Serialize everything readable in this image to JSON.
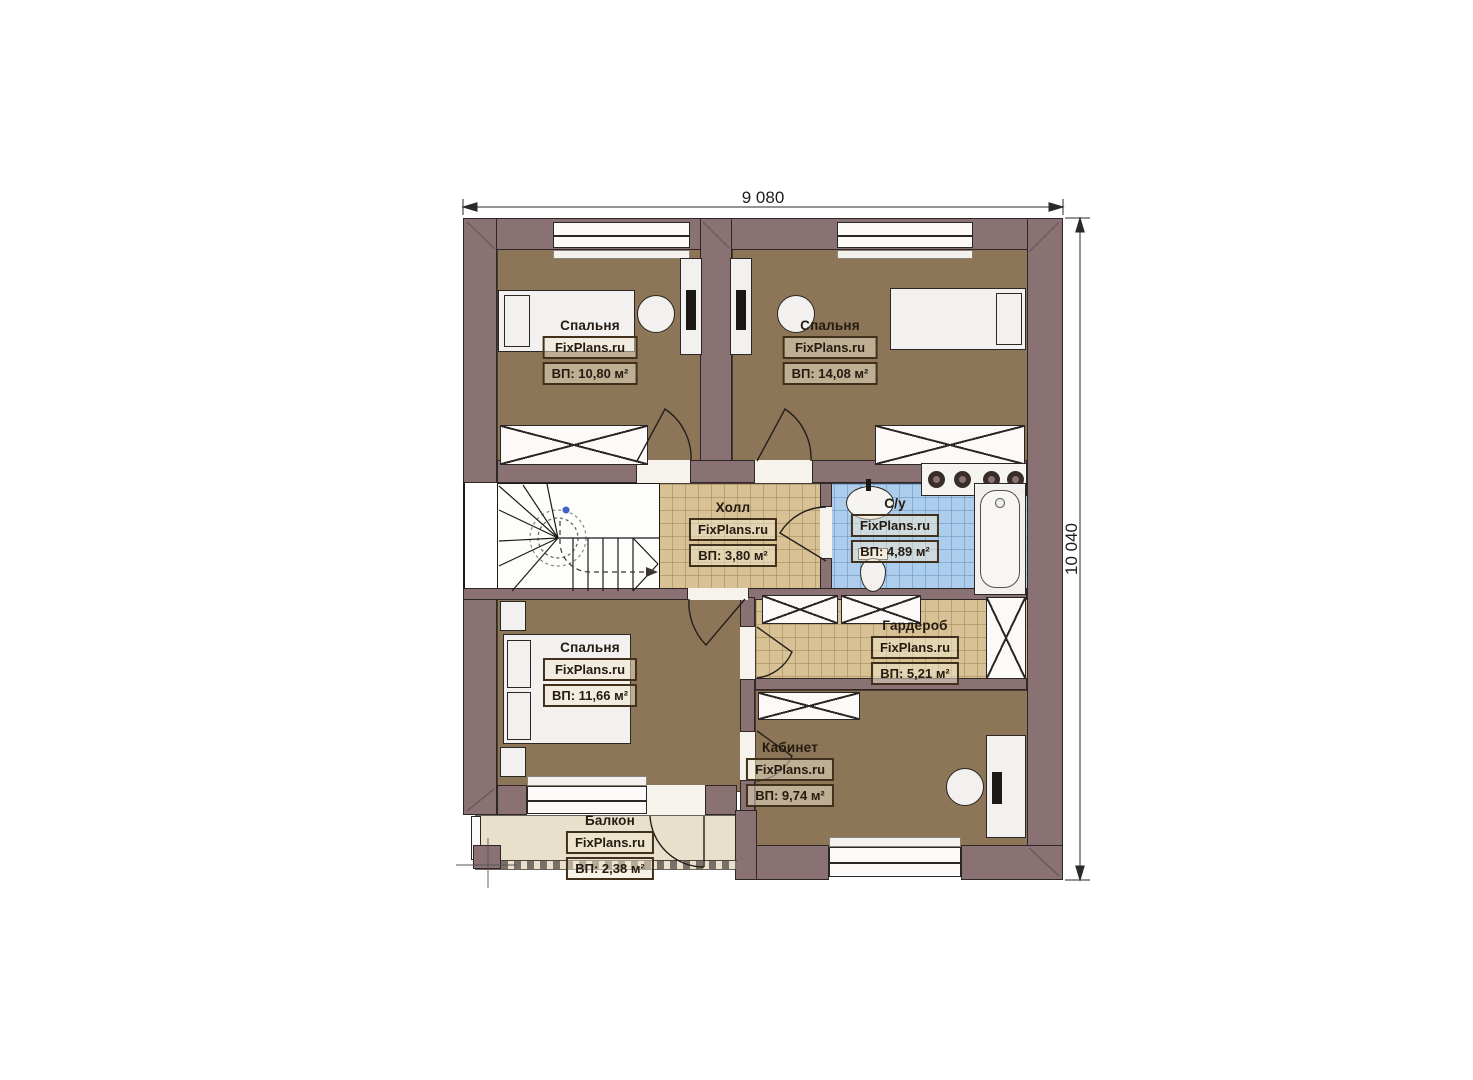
{
  "plan_title": "Floor plan (2nd floor)",
  "dimensions": {
    "top": "9 080",
    "right": "10 040"
  },
  "rooms": [
    {
      "name": "Спальня",
      "watermark": "FixPlans.ru",
      "area": "ВП: 10,80 м²"
    },
    {
      "name": "Спальня",
      "watermark": "FixPlans.ru",
      "area": "ВП: 14,08 м²"
    },
    {
      "name": "Холл",
      "watermark": "FixPlans.ru",
      "area": "ВП: 3,80 м²"
    },
    {
      "name": "С/у",
      "watermark": "FixPlans.ru",
      "area": "ВП: 4,89 м²"
    },
    {
      "name": "Гардероб",
      "watermark": "FixPlans.ru",
      "area": "ВП: 5,21 м²"
    },
    {
      "name": "Спальня",
      "watermark": "FixPlans.ru",
      "area": "ВП: 11,66 м²"
    },
    {
      "name": "Кабинет",
      "watermark": "FixPlans.ru",
      "area": "ВП: 9,74 м²"
    },
    {
      "name": "Балкон",
      "watermark": "FixPlans.ru",
      "area": "ВП: 2,38 м²"
    }
  ],
  "colors": {
    "wall": "#8a7173",
    "bedroom_floor": "#8d7557",
    "tile_beige": "#d8c295",
    "tile_blue": "#accdec",
    "balcony_floor": "#e9e0cb"
  }
}
